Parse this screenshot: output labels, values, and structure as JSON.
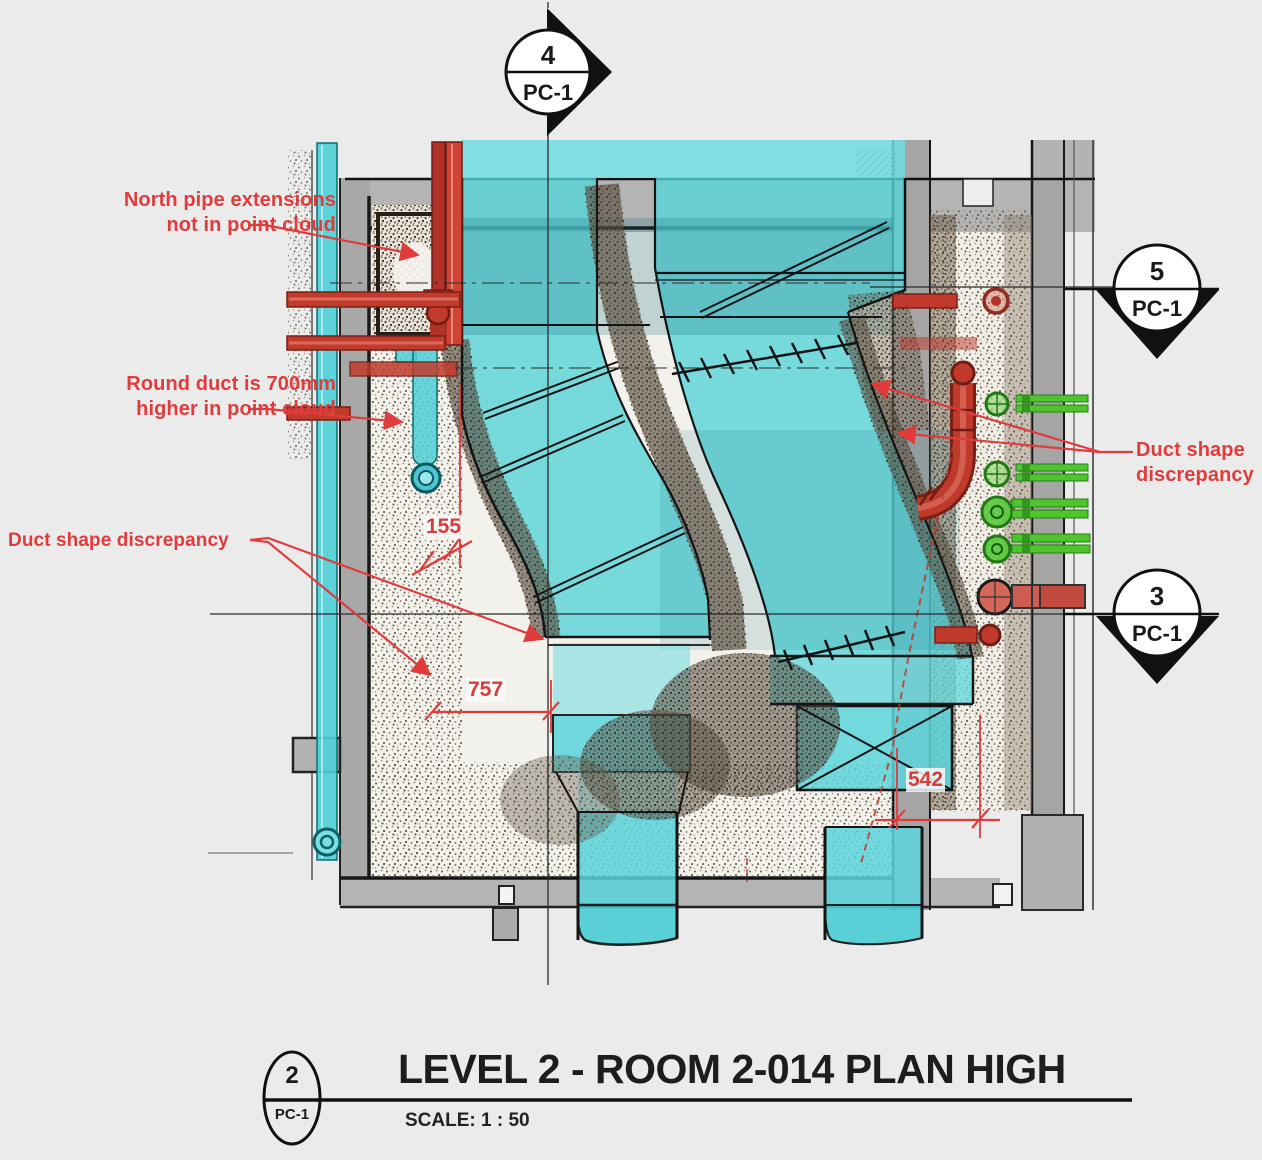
{
  "drawing": {
    "title": "LEVEL 2 - ROOM 2-014 PLAN HIGH",
    "scale_label": "SCALE:  1 : 50"
  },
  "markers": {
    "top": {
      "number": "4",
      "sheet": "PC-1"
    },
    "right_upper": {
      "number": "5",
      "sheet": "PC-1"
    },
    "right_lower": {
      "number": "3",
      "sheet": "PC-1"
    },
    "title_block": {
      "number": "2",
      "sheet": "PC-1"
    }
  },
  "annotations": {
    "north_pipe": {
      "line1": "North pipe extensions",
      "line2": "not in point cloud"
    },
    "round_duct": {
      "line1": "Round duct is 700mm",
      "line2": "higher in point cloud"
    },
    "duct_shape_left": {
      "line1": "Duct shape discrepancy"
    },
    "duct_shape_right": {
      "line1": "Duct shape",
      "line2": "discrepancy"
    }
  },
  "dimensions": {
    "dim_a": "155",
    "dim_b": "757",
    "dim_c": "542"
  },
  "colors": {
    "background": "#ebebec",
    "annotation_red": "#e03c3c",
    "duct_cyan": "#56d4da",
    "pipe_red": "#c03a2c",
    "pipe_green": "#4fc42e",
    "wall_gray": "#b4b4b4",
    "line_black": "#141414",
    "point_cloud_brown": "#6b5d4b"
  }
}
